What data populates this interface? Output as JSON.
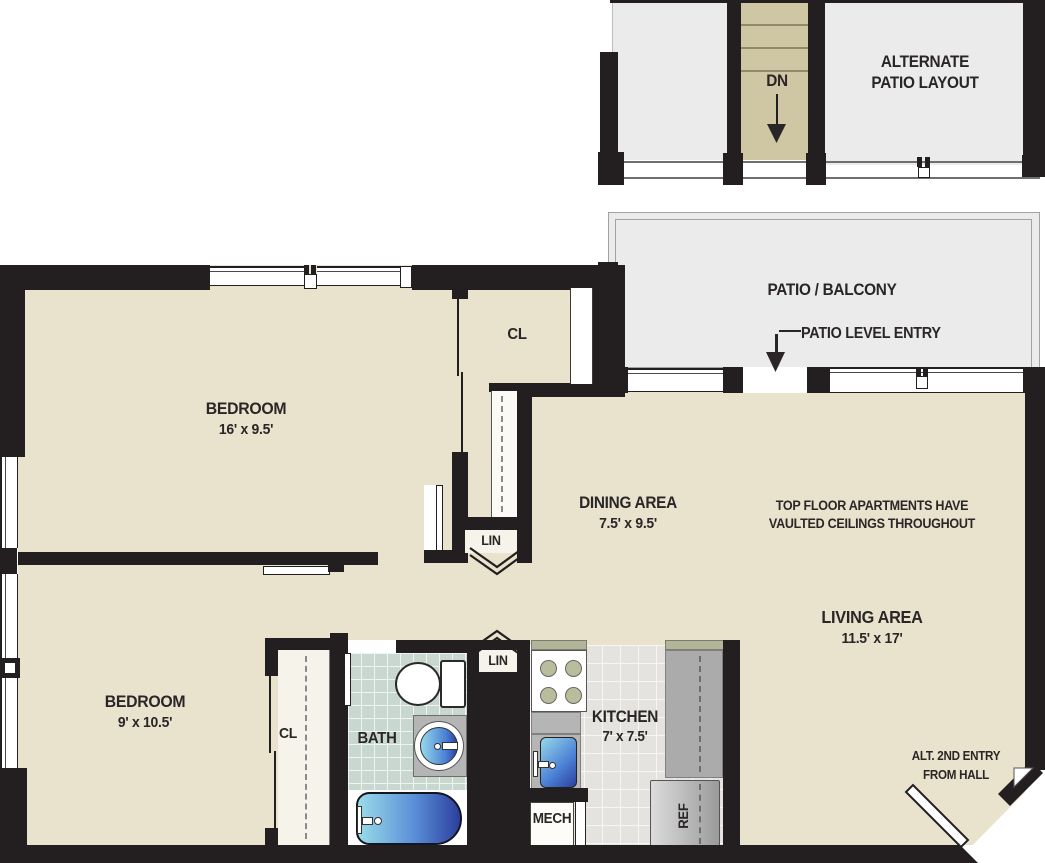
{
  "upper": {
    "dn": "DN",
    "alternate_patio_line1": "ALTERNATE",
    "alternate_patio_line2": "PATIO LAYOUT"
  },
  "patio": {
    "label": "PATIO / BALCONY",
    "entry_label": "PATIO LEVEL ENTRY"
  },
  "rooms": {
    "bedroom1": {
      "label": "BEDROOM",
      "dims": "16' x 9.5'"
    },
    "bedroom2": {
      "label": "BEDROOM",
      "dims": "9' x 10.5'"
    },
    "dining": {
      "label": "DINING AREA",
      "dims": "7.5' x 9.5'"
    },
    "living": {
      "label": "LIVING AREA",
      "dims": "11.5' x 17'"
    },
    "kitchen": {
      "label": "KITCHEN",
      "dims": "7' x 7.5'"
    },
    "bath": {
      "label": "BATH"
    },
    "closet1": {
      "label": "CL"
    },
    "closet2": {
      "label": "CL"
    },
    "linen1": {
      "label": "LIN"
    },
    "linen2": {
      "label": "LIN"
    },
    "mech": {
      "label": "MECH"
    },
    "ref": {
      "label": "REF"
    }
  },
  "notes": {
    "vaulted_line1": "TOP FLOOR APARTMENTS HAVE",
    "vaulted_line2": "VAULTED CEILINGS THROUGHOUT",
    "alt_entry_line1": "ALT. 2ND ENTRY",
    "alt_entry_line2": "FROM HALL"
  },
  "colors": {
    "wall": "#231f20",
    "floor": "#e9e3cd",
    "stair": "#cfc6a4",
    "patio_gray": "#ebebec",
    "bath_tile": "#c9d7d1",
    "kitchen_tile": "#e4e3df",
    "counter": "#b5b5b5",
    "fixture_blue_light": "#96d9ea",
    "fixture_blue_dark": "#2b3f9e",
    "text": "#2a2627"
  }
}
